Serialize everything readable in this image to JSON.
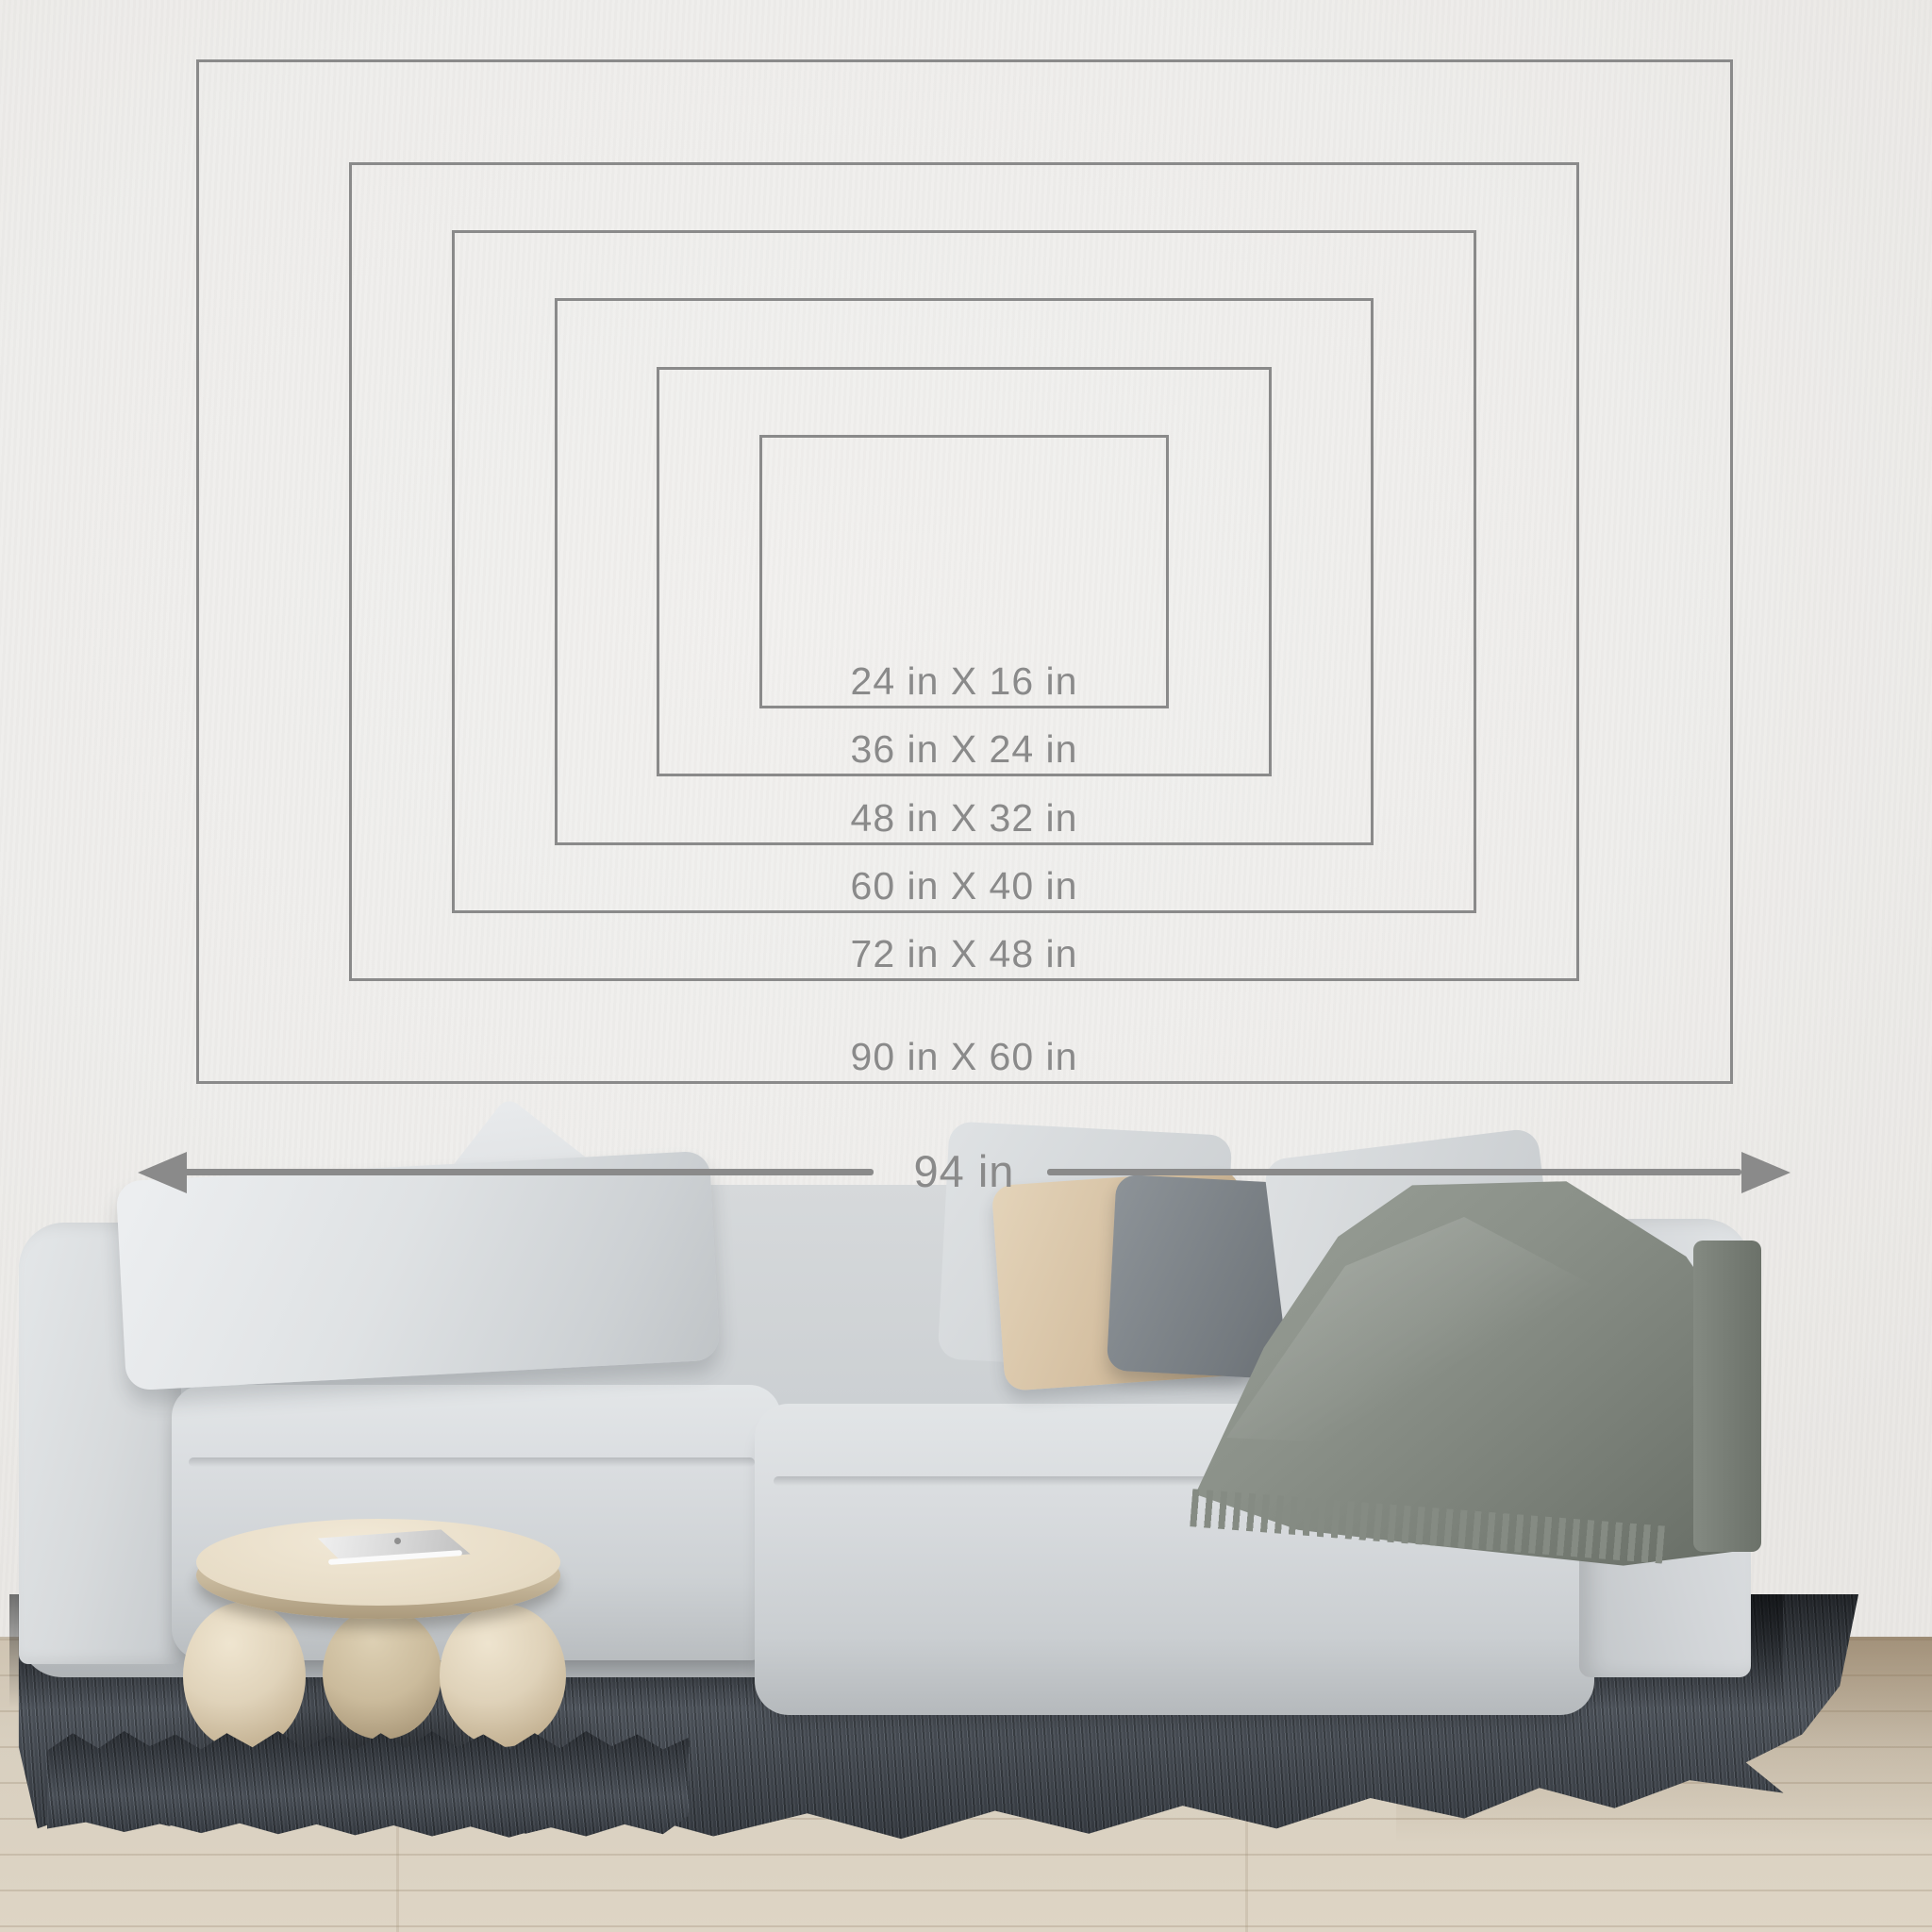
{
  "size_chart": {
    "unit": "in",
    "sizes": [
      {
        "label": "24 in X 16 in",
        "width_in": 24,
        "height_in": 16
      },
      {
        "label": "36 in X 24 in",
        "width_in": 36,
        "height_in": 24
      },
      {
        "label": "48 in X 32 in",
        "width_in": 48,
        "height_in": 32
      },
      {
        "label": "60 in X 40 in",
        "width_in": 60,
        "height_in": 40
      },
      {
        "label": "72 in X 48 in",
        "width_in": 72,
        "height_in": 48
      },
      {
        "label": "90 in X 60 in",
        "width_in": 90,
        "height_in": 60
      }
    ],
    "wall_width_arrow": {
      "label": "94 in",
      "width_in": 94
    },
    "line_color": "#8a8a8a",
    "label_color": "#8a8a8a"
  },
  "scene": {
    "wall_color": "#efeeec",
    "sofa_color": "#d7dadc",
    "pillow_colors": {
      "light": "#e0e3e5",
      "beige": "#d4bfa3",
      "dark_gray": "#767b80"
    },
    "blanket_color": "#8e938b",
    "table_color": "#e7ddc9",
    "laptop_color": "#dddddd",
    "rug_color": "#4b5056",
    "floor_color": "#d6ccbc"
  }
}
